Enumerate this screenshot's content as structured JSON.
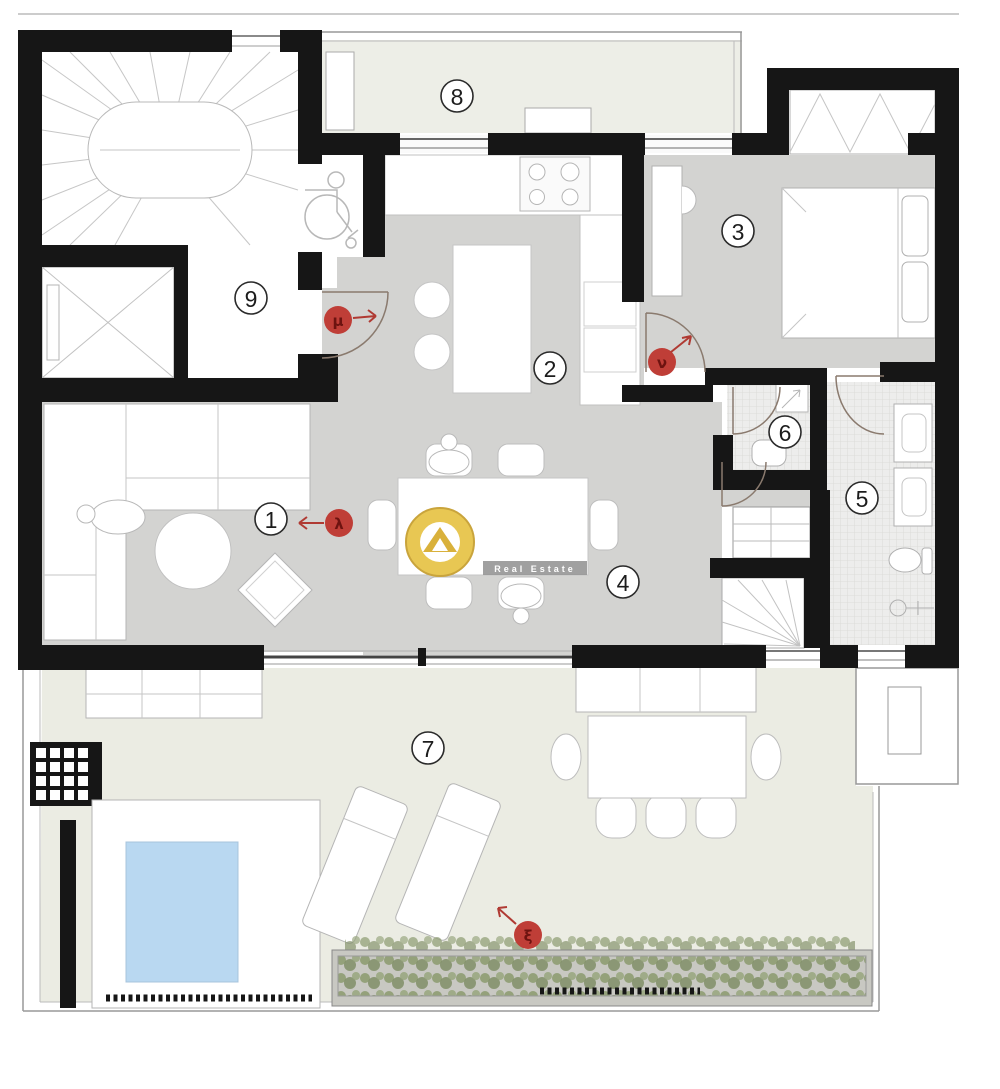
{
  "plan": {
    "type": "apartment-floor-plan",
    "room_labels": [
      "1",
      "2",
      "3",
      "4",
      "5",
      "6",
      "7",
      "8",
      "9"
    ],
    "door_markers": [
      {
        "letter": "μ",
        "arrow": "right"
      },
      {
        "letter": "ν",
        "arrow": "up-right"
      },
      {
        "letter": "λ",
        "arrow": "left"
      },
      {
        "letter": "ξ",
        "arrow": "up-left"
      }
    ],
    "watermark": {
      "line1": "Golden",
      "line2": "Home",
      "tagline": "Real Estate"
    },
    "colors": {
      "wall": "#161616",
      "interior_floor": "#d3d3d1",
      "terrace_floor": "#ebece3",
      "balcony_floor": "#edeee7",
      "tile_floor": "#ededec",
      "pool": "#b9d8f1",
      "plants": "#8e9d72",
      "marker_red": "#bf3e37",
      "marker_letter": "#6d1310",
      "logo_gold": "#e8c753",
      "line_gray": "#999999"
    }
  }
}
